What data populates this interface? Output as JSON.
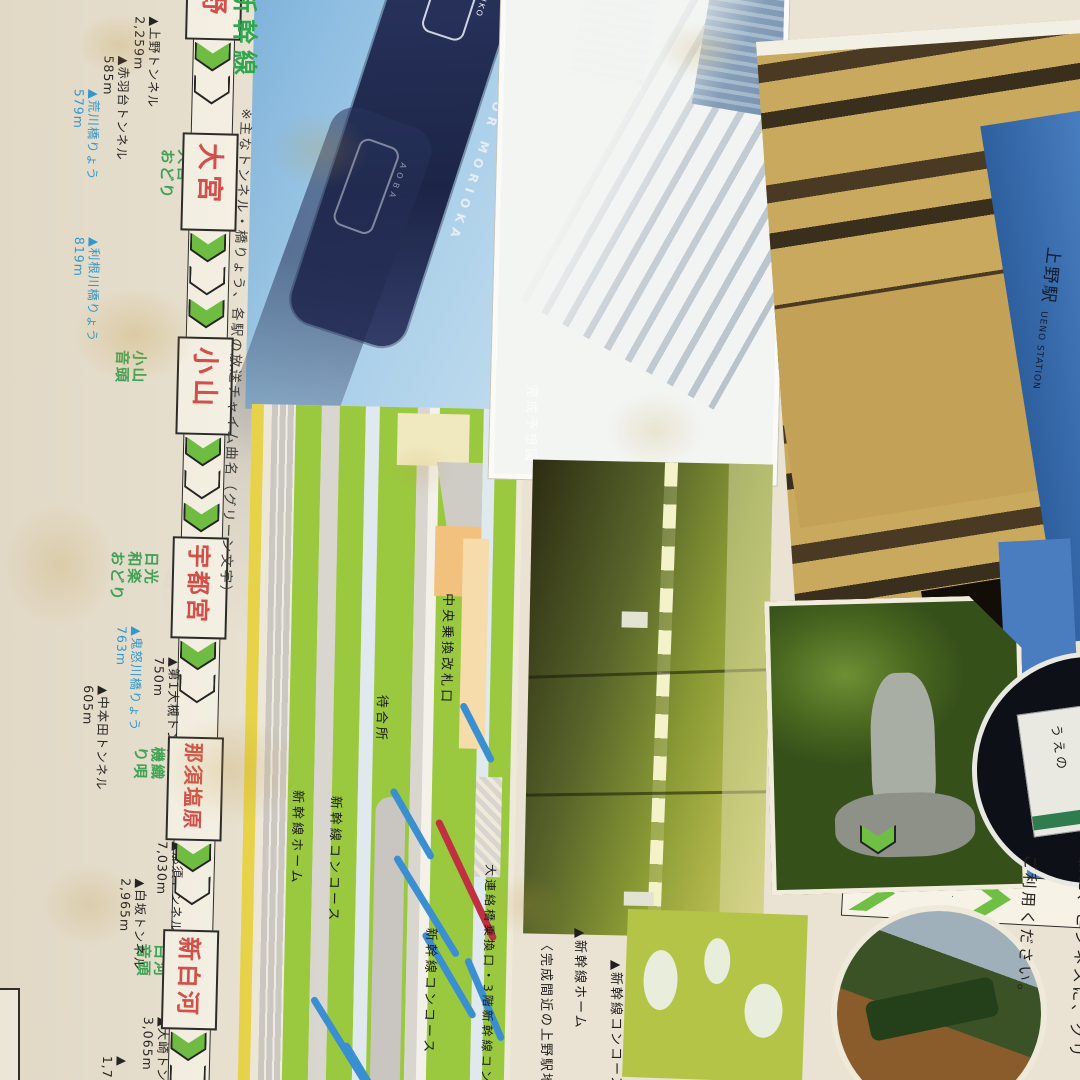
{
  "header": {
    "title": "新幹線"
  },
  "note": "※主なトンネル・橋りょう、各駅の放送チャイム曲名（グリーン文字）",
  "route": {
    "stations": [
      {
        "name": "上野",
        "song_lines": []
      },
      {
        "name": "大宮",
        "song_lines": [
          "大宮",
          "おどり"
        ]
      },
      {
        "name": "小山",
        "song_lines": [
          "小山",
          "音頭"
        ]
      },
      {
        "name": "宇都宮",
        "song_lines": [
          "日光",
          "和楽",
          "おどり"
        ]
      },
      {
        "name": "那須塩原",
        "song_lines": [
          "機織",
          "り唄"
        ]
      },
      {
        "name": "新白河",
        "song_lines": [
          "白河",
          "音頭"
        ]
      }
    ],
    "features": [
      {
        "name": "▲上野トンネル",
        "length": "2,259m",
        "type": "tunnel"
      },
      {
        "name": "▲赤羽台トンネル",
        "length": "585m",
        "type": "tunnel"
      },
      {
        "name": "▲荒川橋りょう",
        "length": "579m",
        "type": "bridge"
      },
      {
        "name": "▲利根川橋りょう",
        "length": "819m",
        "type": "bridge"
      },
      {
        "name": "▲鬼怒川橋りょう",
        "length": "763m",
        "type": "bridge"
      },
      {
        "name": "▲第1大槻トンネル",
        "length": "750m",
        "type": "tunnel"
      },
      {
        "name": "▲中本田トンネル",
        "length": "605m",
        "type": "tunnel"
      },
      {
        "name": "▲那須トンネル",
        "length": "7,030m",
        "type": "tunnel"
      },
      {
        "name": "▲白坂トンネル",
        "length": "2,965m",
        "type": "tunnel"
      },
      {
        "name": "▲大崎トンネル",
        "length": "3,065m",
        "type": "tunnel"
      },
      {
        "name": "▲",
        "length": "1,7",
        "type": "tunnel"
      }
    ]
  },
  "headsigns": [
    {
      "kana": "やまびこ",
      "kana_latin": "YAMABIKO",
      "dest": "盛岡",
      "dest_latin": "FOR MORIOKA"
    },
    {
      "kana": "あおば",
      "kana_latin": "A O B A",
      "dest": "仙台",
      "dest_latin": "FOR"
    }
  ],
  "station_map": {
    "central_gate": "中央乗換改札口",
    "waiting_room": "待合所",
    "platform": "新幹線ホーム",
    "concourse1": "新幹線コンコース",
    "concourse2": "新幹線コンコース",
    "bridge_gate": "大連絡橋乗換口・3階新幹線コンコース"
  },
  "photos": {
    "aerial_caption": "完成予想図",
    "platform_caption": "▲新幹線ホーム",
    "concourse_caption": "▲新幹線コンコース",
    "construction_caption": "〈完成間近の上野駅地",
    "station_caption_jp": "上野駅",
    "station_caption_en": "UENO STATION",
    "inset_sign_text": "うえの"
  },
  "message": {
    "lines": [
      "上野駅から東北・上越新",
      "出発いたします。",
      "みちのくへ…、えちごへ",
      "旅に、ビジネスに、グリ",
      "ご利用ください。"
    ]
  },
  "colors": {
    "chevron_green": "#6fbf44",
    "station_red": "#d4504a",
    "song_green": "#3fa557",
    "bridge_blue": "#2e9bd6",
    "band_blue": "#9ec7e6",
    "sign_navy": "#232e58",
    "map_green": "#9ac93f"
  }
}
